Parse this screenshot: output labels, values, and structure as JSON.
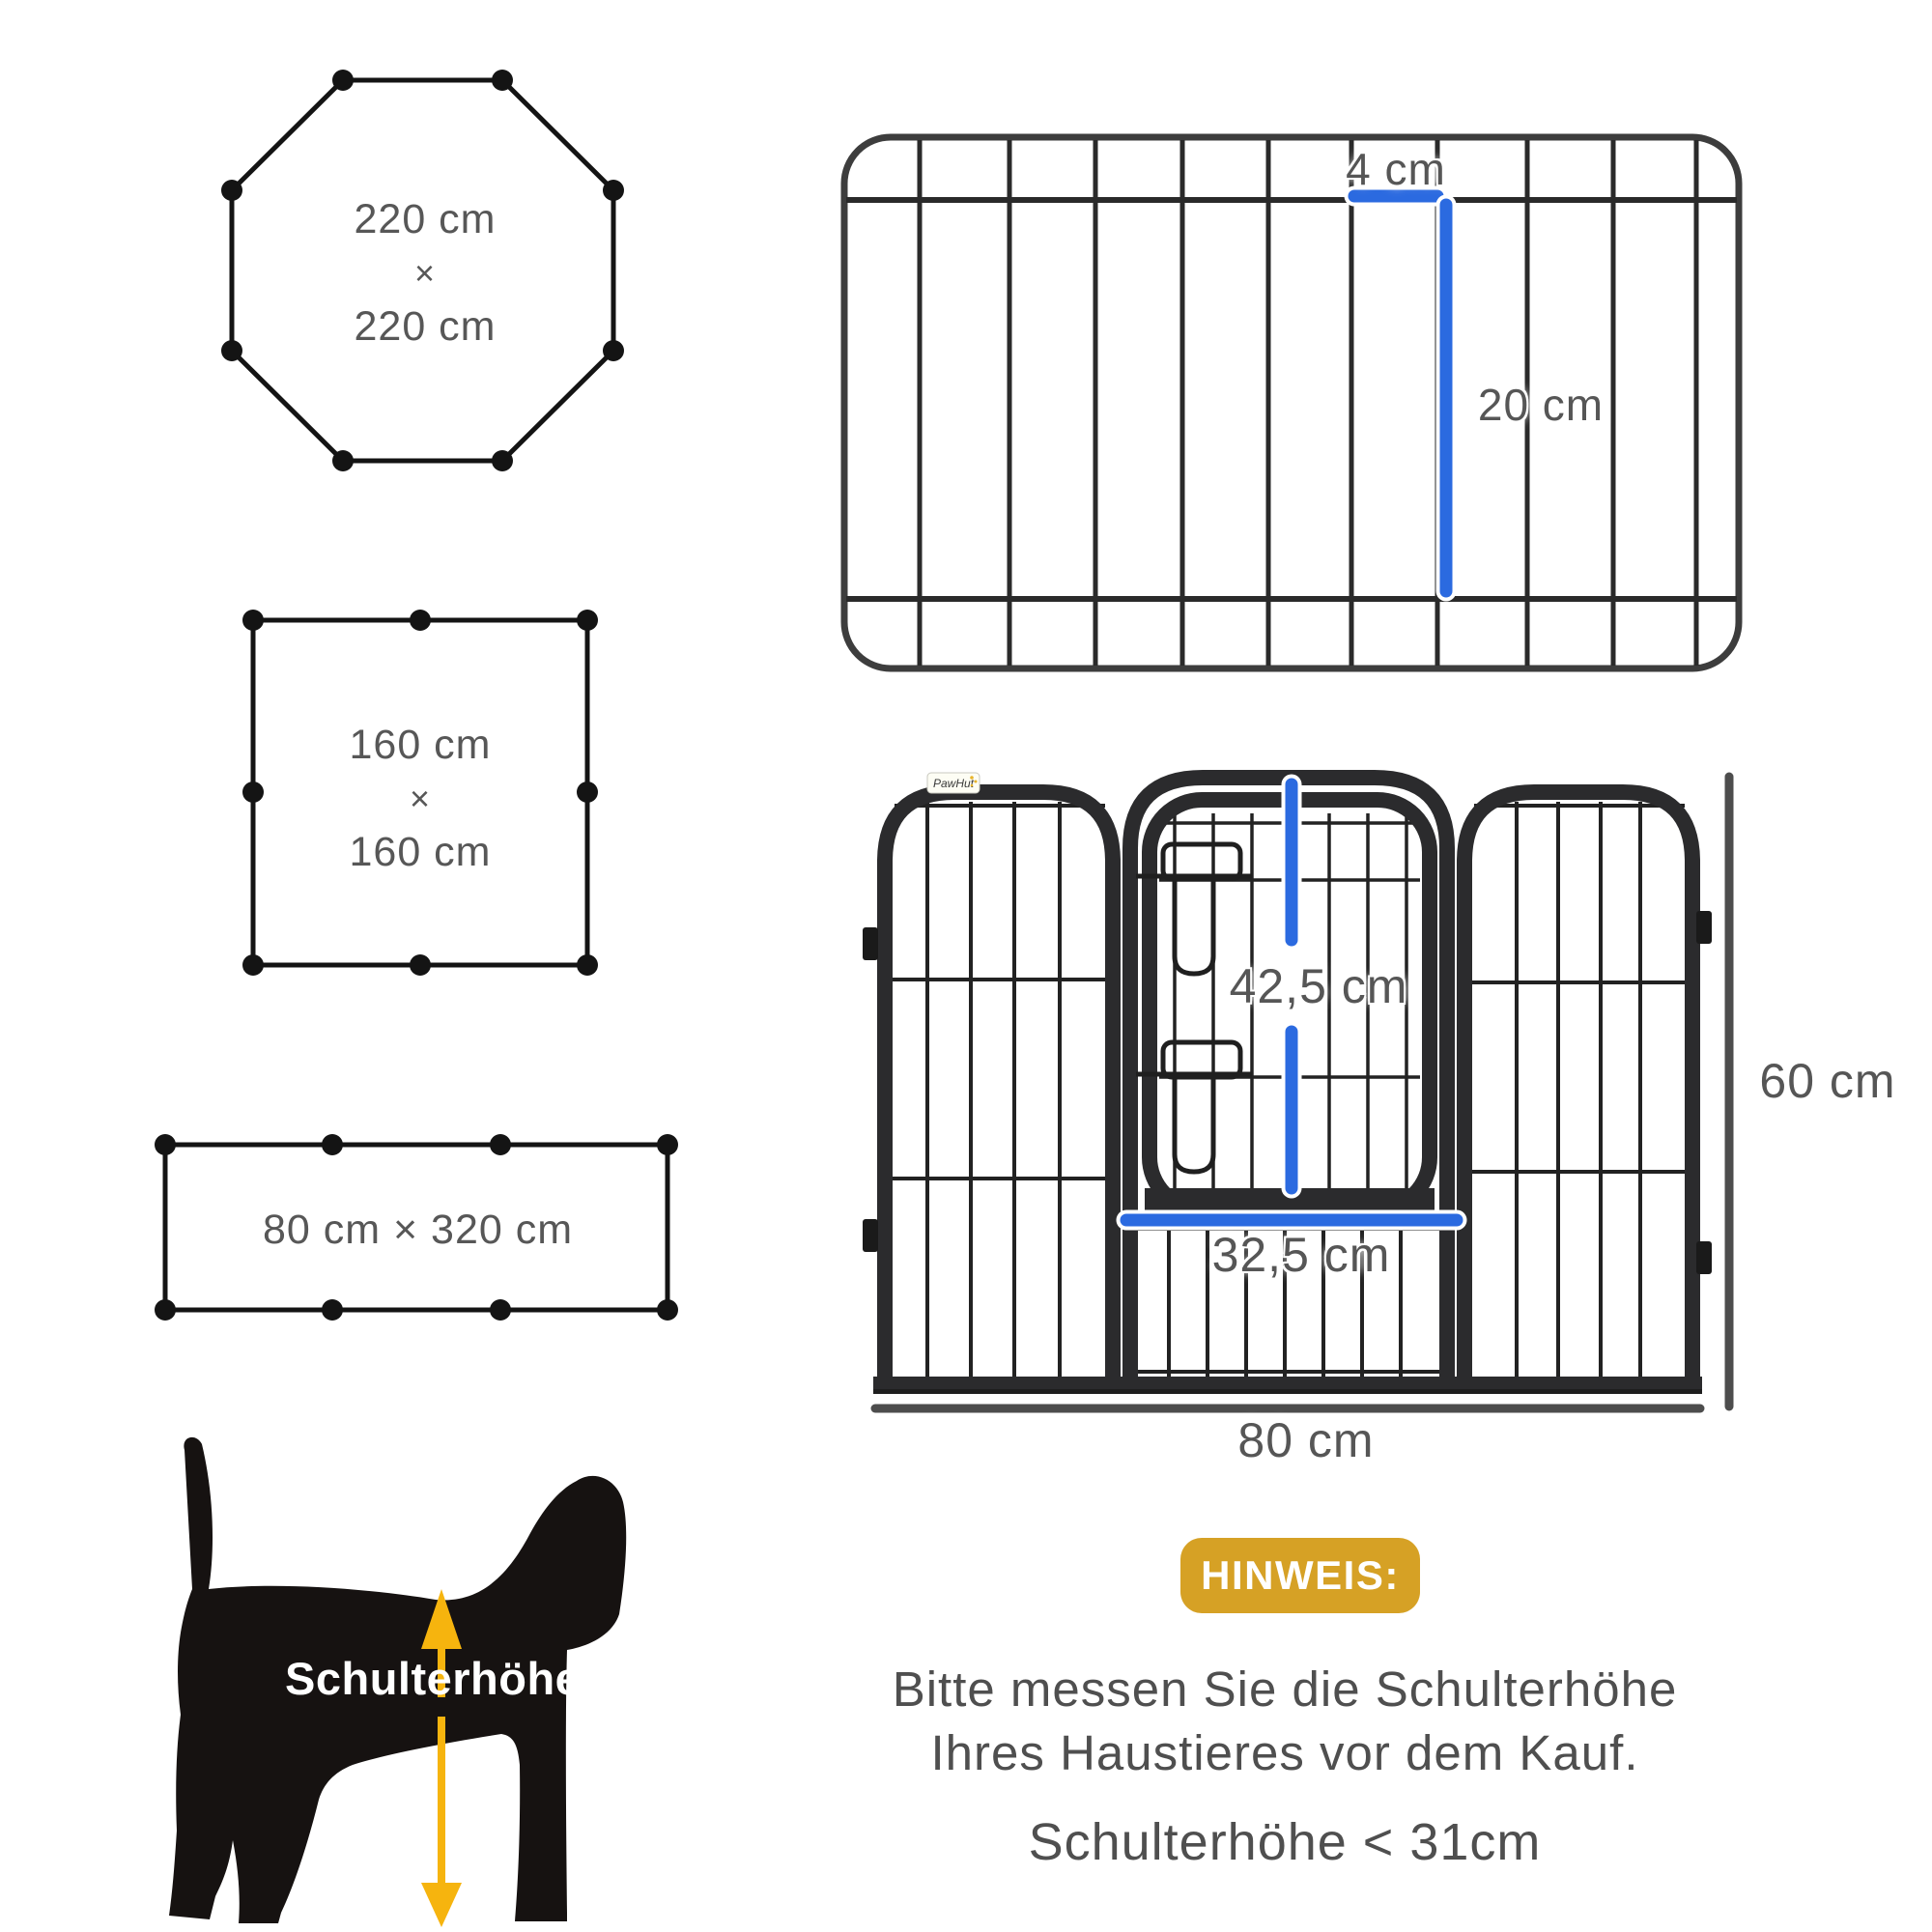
{
  "shapes": {
    "octagon": {
      "width": "220 cm",
      "times": "×",
      "height": "220 cm"
    },
    "square": {
      "width": "160 cm",
      "times": "×",
      "height": "160 cm"
    },
    "rectangle": {
      "label": "80 cm × 320 cm"
    }
  },
  "top_panel": {
    "bar_gap": "4 cm",
    "bar_height": "20 cm"
  },
  "fence": {
    "brand": "PawHut",
    "door_height": "42,5 cm",
    "door_width": "32,5 cm",
    "panel_height": "60 cm",
    "panel_width": "80 cm"
  },
  "dog": {
    "shoulder_label": "Schulterhöhe"
  },
  "notice": {
    "badge": "HINWEIS:",
    "line1": "Bitte messen Sie die Schulterhöhe",
    "line2": "Ihres Haustieres vor dem Kauf.",
    "line3": "Schulterhöhe < 31cm"
  },
  "colors": {
    "measure_blue": "#2b6ae0",
    "measure_gray": "#4d4d4d",
    "frame_black": "#2b2b2d",
    "badge_gold": "#d6a125",
    "arrow_yellow": "#f6b40e"
  }
}
